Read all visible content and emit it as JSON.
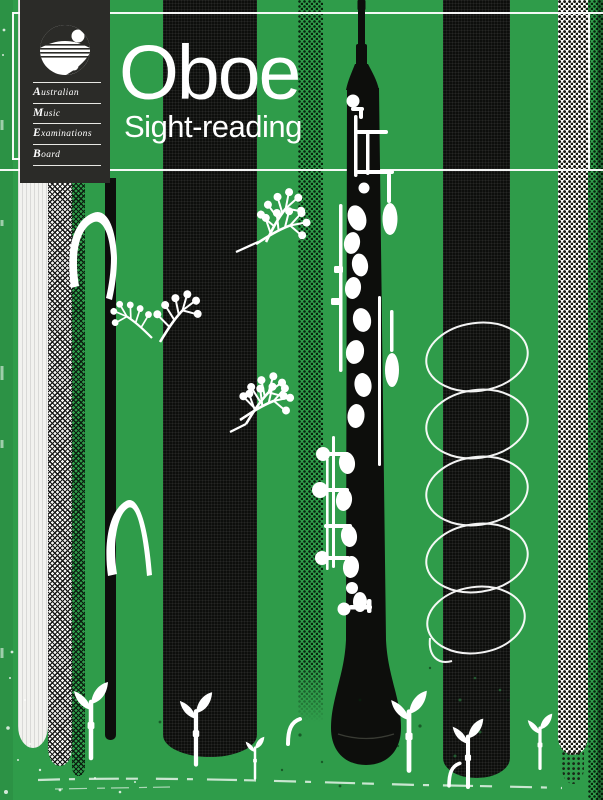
{
  "cover": {
    "title": "Oboe",
    "subtitle": "Sight-reading"
  },
  "publisher": {
    "name_rows": [
      {
        "cap": "A",
        "rest": "ustralian"
      },
      {
        "cap": "M",
        "rest": "usic"
      },
      {
        "cap": "E",
        "rest": "xaminations"
      },
      {
        "cap": "B",
        "rest": "oard"
      }
    ],
    "logo_icon": "ameb-circle-logo-icon"
  },
  "colors": {
    "background_green": "#2F9C4A",
    "ink_black": "#0D0E0C",
    "panel_black": "#2B2B28",
    "white": "#FFFFFF",
    "off_white": "#F2F2EF"
  },
  "art": {
    "instrument": "oboe-illustration",
    "decorations": [
      "coil-spring-decoration",
      "berry-sprig-decoration",
      "seedling-decoration",
      "bent-stalk-decoration",
      "halftone-dot-stripe",
      "woven-check-stripe",
      "grunge-scratches"
    ]
  }
}
